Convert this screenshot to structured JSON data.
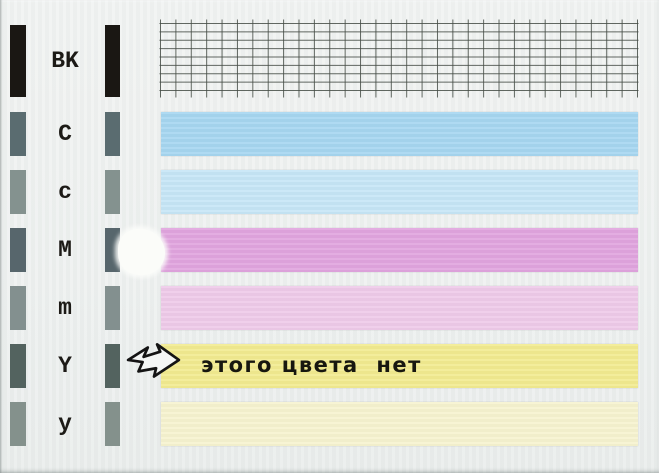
{
  "paper": {
    "background": "#edf0ef"
  },
  "channels": [
    {
      "label": "BK",
      "bar_color": "#1a1713",
      "band": "nozzle-grid"
    },
    {
      "label": "C",
      "bar_color": "#5a6c70",
      "band_color": "#a6d6f0"
    },
    {
      "label": "c",
      "bar_color": "#84928f",
      "band_color": "#c6e5f6"
    },
    {
      "label": "M",
      "bar_color": "#57666c",
      "band_color": "#e0a4de"
    },
    {
      "label": "m",
      "bar_color": "#83908f",
      "band_color": "#eecae9"
    },
    {
      "label": "Y",
      "bar_color": "#53635f",
      "band_color": "#f2eb90"
    },
    {
      "label": "y",
      "bar_color": "#84918c",
      "band_color": "#f6f3cf"
    }
  ],
  "grid": {
    "line_color": "#474d47",
    "rows": 8,
    "columns": 31
  },
  "annotation": {
    "text": "этого цвета  нет",
    "color": "#17170f",
    "arrow_icon": "hand-drawn-right-arrow",
    "arrow_stroke": "#141414",
    "arrow_fill": "#f4f6f5"
  },
  "defect": {
    "name": "white-correction-smudge"
  }
}
